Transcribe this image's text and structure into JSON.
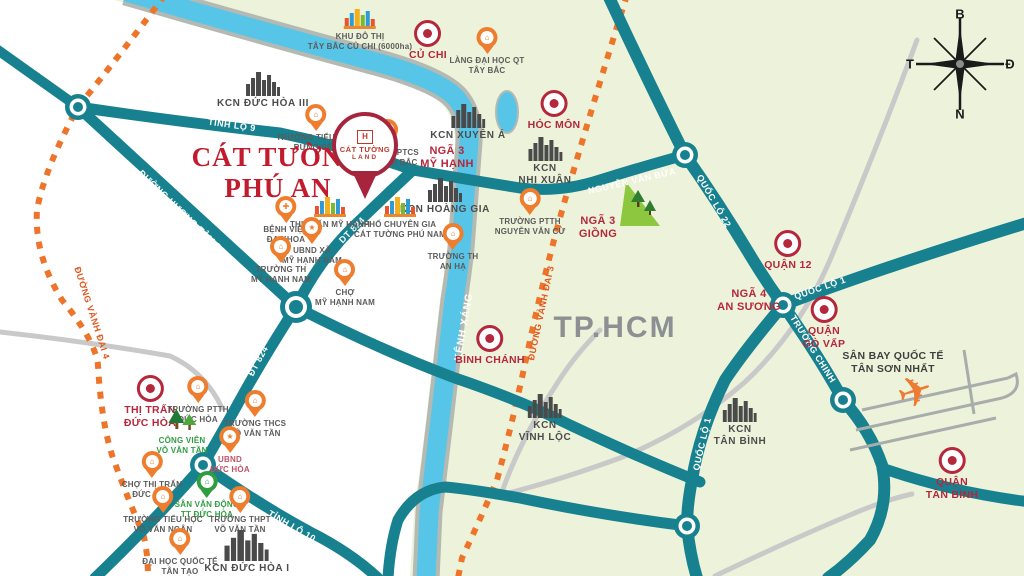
{
  "colors": {
    "land_green": "#edf3da",
    "land_white": "#ffffff",
    "road_teal": "#17818f",
    "road_gray": "#c9c9c9",
    "river_blue": "#57c5e8",
    "river_casing": "#b4bab2",
    "expressway_orange": "#ee7429",
    "marker_red": "#b5273b",
    "pin_orange": "#ee7d2e",
    "label_gray": "#5b5b5b",
    "kcn_gray": "#4c4c4c",
    "green_label": "#2f9e41",
    "title_red": "#c21b2e",
    "area_gray": "#8d9093"
  },
  "title": {
    "line1": "CÁT TƯỜNG",
    "line2": "PHÚ AN"
  },
  "project_pin": {
    "logo_text": "H",
    "name_line1": "CÁT TƯỜNG",
    "name_line2": "LAND"
  },
  "compass": {
    "north": "B",
    "south": "N",
    "east": "Đ",
    "west": "T"
  },
  "icons": {
    "airplane": "✈"
  },
  "markers": [
    {
      "name": "khu-do-thi-tay-bac-cu-chi",
      "type": "city",
      "x": 360,
      "y": 8,
      "label": "KHU ĐÔ THỊ\nTÂY BẮC CỦ CHI (6000ha)"
    },
    {
      "name": "cu-chi",
      "type": "district",
      "x": 428,
      "y": 20,
      "label": "CỦ CHI"
    },
    {
      "name": "lang-dai-hoc-qt-tay-bac",
      "type": "pin",
      "x": 487,
      "y": 27,
      "label": "LÀNG ĐẠI HỌC QT\nTÂY BẮC"
    },
    {
      "name": "hoc-mon",
      "type": "district",
      "x": 554,
      "y": 90,
      "label": "HÓC MÔN"
    },
    {
      "name": "kcn-duc-hoa-3",
      "type": "factory",
      "x": 263,
      "y": 72,
      "label": "KCN ĐỨC HÒA III"
    },
    {
      "name": "truong-tieu-hoc-rung-sen",
      "type": "pin",
      "x": 316,
      "y": 104,
      "label": "TRƯỜNG TIỂU HỌC\nRỪNG SẾN"
    },
    {
      "name": "cho-dinh",
      "type": "pin",
      "x": 352,
      "y": 122,
      "label": "CHỢ ĐÌNH"
    },
    {
      "name": "truong-ptcs-my-hanh-bac",
      "type": "pin",
      "x": 388,
      "y": 119,
      "label": "TRƯỜNG PTCS\nMỸ HẠNH BẮC"
    },
    {
      "name": "kcn-xuyen-a",
      "type": "factory",
      "x": 468,
      "y": 104,
      "label": "KCN XUYÊN Á"
    },
    {
      "name": "nga-3-my-hanh",
      "type": "text-red",
      "x": 447,
      "y": 143,
      "label": "NGÃ 3\nMỸ HẠNH"
    },
    {
      "name": "kcn-nhi-xuan",
      "type": "factory",
      "x": 545,
      "y": 137,
      "label": "KCN\nNHỊ XUÂN"
    },
    {
      "name": "truong-ptth-nguyen-van-cu",
      "type": "pin",
      "x": 530,
      "y": 188,
      "label": "TRƯỜNG PTTH\nNGUYỄN VĂN CỪ"
    },
    {
      "name": "nga-3-giong",
      "type": "text-red",
      "x": 598,
      "y": 213,
      "label": "NGÃ 3\nGIỒNG"
    },
    {
      "name": "kcn-hoang-gia",
      "type": "factory",
      "x": 445,
      "y": 178,
      "label": "KCN HOÀNG GIA"
    },
    {
      "name": "thi-tran-my-hanh",
      "type": "city",
      "x": 330,
      "y": 196,
      "label": "THỊ TRẤN MỸ HẠNH"
    },
    {
      "name": "pho-chuyen-gia-cat-tuong-phu-nam",
      "type": "city",
      "x": 400,
      "y": 196,
      "label": "PHỐ CHUYÊN GIA\nCÁT TƯỜNG PHÚ NAM"
    },
    {
      "name": "benh-vien-da-khoa",
      "type": "pin",
      "glyph": "✚",
      "x": 286,
      "y": 196,
      "label": "BỆNH VIỆN\nĐA KHOA"
    },
    {
      "name": "ubnd-xa-my-hanh-nam",
      "type": "pin",
      "glyph": "★",
      "x": 312,
      "y": 217,
      "label": "UBND XÃ\nMỸ HẠNH NAM"
    },
    {
      "name": "truong-th-my-hanh-nam",
      "type": "pin",
      "x": 281,
      "y": 236,
      "label": "TRƯỜNG TH\nMỸ HẠNH NAM"
    },
    {
      "name": "cho-my-hanh-nam",
      "type": "pin",
      "x": 345,
      "y": 259,
      "label": "CHỢ\nMỸ HẠNH NAM"
    },
    {
      "name": "truong-th-an-ha",
      "type": "pin",
      "x": 453,
      "y": 223,
      "label": "TRƯỜNG TH\nAN HẠ"
    },
    {
      "name": "binh-chanh",
      "type": "district",
      "x": 490,
      "y": 325,
      "label": "BÌNH CHÁNH"
    },
    {
      "name": "thi-tran-duc-hoa",
      "type": "district",
      "x": 150,
      "y": 375,
      "label": "THỊ TRẤN\nĐỨC HÒA"
    },
    {
      "name": "truong-ptth-duc-hoa",
      "type": "pin",
      "x": 198,
      "y": 376,
      "label": "TRƯỜNG PTTH\nĐỨC HÒA"
    },
    {
      "name": "truong-thcs-vo-van-tan",
      "type": "pin",
      "x": 255,
      "y": 390,
      "label": "TRƯỜNG THCS\nVÕ VĂN TẦN"
    },
    {
      "name": "cong-vien-vo-van-tan",
      "type": "park",
      "x": 182,
      "y": 408,
      "label": "CÔNG VIÊN\nVÕ VĂN TẦN"
    },
    {
      "name": "ubnd-duc-hoa",
      "type": "pin",
      "glyph": "★",
      "x": 230,
      "y": 426,
      "label": "UBND\nĐỨC HÒA",
      "label_color": "#bf5368"
    },
    {
      "name": "cho-thi-tran-duc-hoa",
      "type": "pin",
      "x": 152,
      "y": 451,
      "label": "CHỢ THỊ TRẤN\nĐỨC HÒA"
    },
    {
      "name": "san-van-dong-tt-duc-hoa",
      "type": "pin-green",
      "x": 207,
      "y": 471,
      "label": "SÂN VẬN ĐỘNG\nTT ĐỨC HÒA",
      "label_color": "#2f9e41"
    },
    {
      "name": "truong-tieu-hoc-vo-van-ngan",
      "type": "pin",
      "x": 163,
      "y": 486,
      "label": "TRƯỜNG TIỂU HỌC\nVÕ VĂN NGÂN"
    },
    {
      "name": "truong-thpt-vo-van-tan",
      "type": "pin",
      "x": 240,
      "y": 486,
      "label": "TRƯỜNG THPT\nVÕ VĂN TẦN"
    },
    {
      "name": "dai-hoc-quoc-te-tan-tao",
      "type": "pin",
      "x": 180,
      "y": 528,
      "label": "ĐẠI HỌC QUỐC TẾ\nTÂN TẠO"
    },
    {
      "name": "kcn-duc-hoa-1",
      "type": "factory-lg",
      "x": 247,
      "y": 530,
      "label": "KCN ĐỨC HÒA I"
    },
    {
      "name": "kcn-vinh-loc",
      "type": "factory",
      "x": 545,
      "y": 394,
      "label": "KCN\nVĨNH LỘC"
    },
    {
      "name": "kcn-tan-binh",
      "type": "factory",
      "x": 740,
      "y": 398,
      "label": "KCN\nTÂN BÌNH"
    },
    {
      "name": "quan-12",
      "type": "district",
      "x": 788,
      "y": 230,
      "label": "QUẬN 12"
    },
    {
      "name": "nga-4-an-suong",
      "type": "text-red",
      "x": 749,
      "y": 286,
      "label": "NGÃ 4\nAN SƯƠNG"
    },
    {
      "name": "quan-go-vap",
      "type": "district",
      "x": 824,
      "y": 296,
      "label": "QUẬN\nGÒ VẤP"
    },
    {
      "name": "san-bay-quoc-te-tan-son-nhat",
      "type": "text-dark",
      "x": 893,
      "y": 348,
      "label": "SÂN BAY QUỐC TẾ\nTÂN SƠN NHẤT"
    },
    {
      "name": "quan-tan-binh",
      "type": "district",
      "x": 952,
      "y": 447,
      "label": "QUẬN\nTÂN BÌNH"
    },
    {
      "name": "tp-hcm",
      "type": "area",
      "x": 615,
      "y": 308,
      "label": "TP.HCM"
    }
  ],
  "road_labels": [
    {
      "text": "TỈNH LỘ 9",
      "x": 232,
      "y": 125,
      "rot": 8,
      "style": "teal"
    },
    {
      "text": "ĐƯỜNG HƯƠNG TÂM DH",
      "x": 183,
      "y": 213,
      "rot": 44,
      "style": "teal"
    },
    {
      "text": "DT 824",
      "x": 352,
      "y": 230,
      "rot": -45,
      "style": "teal"
    },
    {
      "text": "ĐT 824",
      "x": 258,
      "y": 361,
      "rot": -62,
      "style": "teal"
    },
    {
      "text": "TỈNH LỘ 10",
      "x": 292,
      "y": 526,
      "rot": 30,
      "style": "teal"
    },
    {
      "text": "NGUYỄN VĂN BỨA",
      "x": 632,
      "y": 181,
      "rot": -13,
      "style": "teal"
    },
    {
      "text": "QUỐC LỘ 22",
      "x": 714,
      "y": 201,
      "rot": 60,
      "style": "teal"
    },
    {
      "text": "QUỐC LỘ 1",
      "x": 820,
      "y": 288,
      "rot": -19,
      "style": "teal"
    },
    {
      "text": "TRƯỜNG CHINH",
      "x": 813,
      "y": 349,
      "rot": 58,
      "style": "teal"
    },
    {
      "text": "QUỐC LỘ 1",
      "x": 702,
      "y": 444,
      "rot": -77,
      "style": "teal"
    },
    {
      "text": "ĐƯỜNG VÀNH ĐAI 4",
      "x": 92,
      "y": 313,
      "rot": 72,
      "style": "orange"
    },
    {
      "text": "ĐƯỜNG VÀNH ĐAI 3",
      "x": 541,
      "y": 313,
      "rot": -78,
      "style": "orange"
    },
    {
      "text": "KÊNH XÁNG",
      "x": 464,
      "y": 327,
      "rot": -80,
      "style": "river"
    }
  ]
}
